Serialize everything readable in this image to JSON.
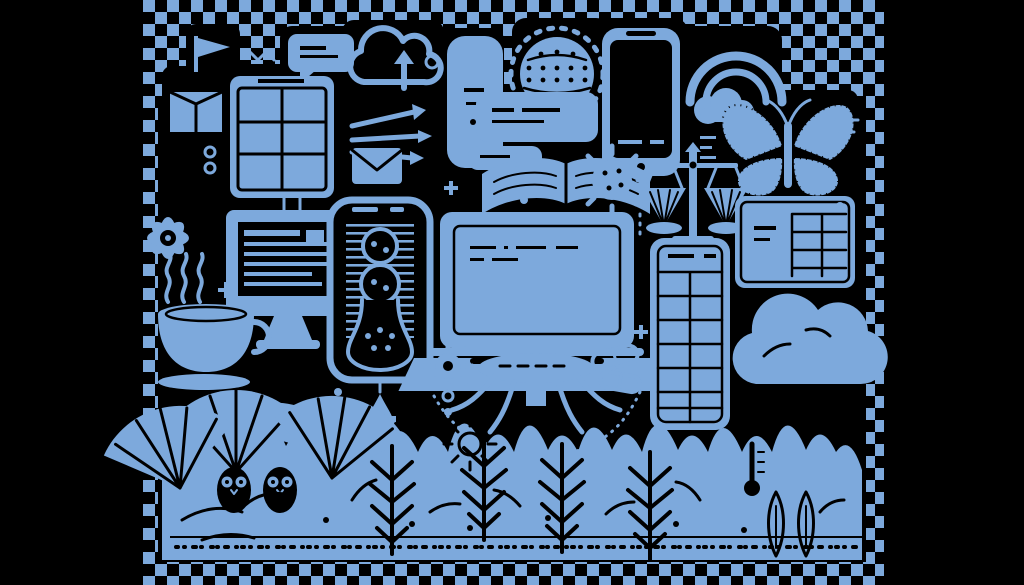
{
  "image": {
    "kind": "transparent-png-preview",
    "description": "Dense monochrome doodle collage of technology and nature objects, drawn in a single blue on black, displayed over a transparency checkerboard with black letterbox bands on the left and right.",
    "width": 1024,
    "height": 585
  },
  "palette": {
    "artwork_blue": "#7da9dc",
    "background_black": "#000000"
  },
  "checkerboard": {
    "x": 143,
    "y": 0,
    "width": 741,
    "height": 585,
    "square_px": 12
  },
  "artwork_bounds": {
    "x": 158,
    "y": 24,
    "width": 708,
    "height": 538
  },
  "scene": {
    "items": [
      {
        "name": "flag-icon"
      },
      {
        "name": "chat-bubble-icon"
      },
      {
        "name": "upload-cloud-icon"
      },
      {
        "name": "tall-panel-icon"
      },
      {
        "name": "dotted-globe-icon"
      },
      {
        "name": "smartphone-icon"
      },
      {
        "name": "rainbow-cloud-icon"
      },
      {
        "name": "butterfly-icon"
      },
      {
        "name": "package-box-icon"
      },
      {
        "name": "tablet-grid-icon"
      },
      {
        "name": "speech-rect-icon"
      },
      {
        "name": "arrows-burst-icon"
      },
      {
        "name": "envelope-icon"
      },
      {
        "name": "open-book-icon"
      },
      {
        "name": "virus-icon"
      },
      {
        "name": "balance-scales-icon"
      },
      {
        "name": "card-table-icon"
      },
      {
        "name": "desktop-monitor-icon"
      },
      {
        "name": "hourglass-phone-icon"
      },
      {
        "name": "laptop-icon"
      },
      {
        "name": "grid-tower-icon"
      },
      {
        "name": "big-cloud-icon"
      },
      {
        "name": "coffee-cup-icon"
      },
      {
        "name": "flower-icon"
      },
      {
        "name": "milk-jug-icon"
      },
      {
        "name": "jellyfish-table-icon"
      },
      {
        "name": "capsules-icon"
      },
      {
        "name": "gear-icon"
      },
      {
        "name": "water-drop-icon"
      },
      {
        "name": "thermometer-icon"
      },
      {
        "name": "fan-palm-leaves"
      },
      {
        "name": "fern-fronds"
      },
      {
        "name": "owl-pair"
      },
      {
        "name": "poplar-trees"
      },
      {
        "name": "foliage-band"
      },
      {
        "name": "ground-line"
      }
    ]
  }
}
